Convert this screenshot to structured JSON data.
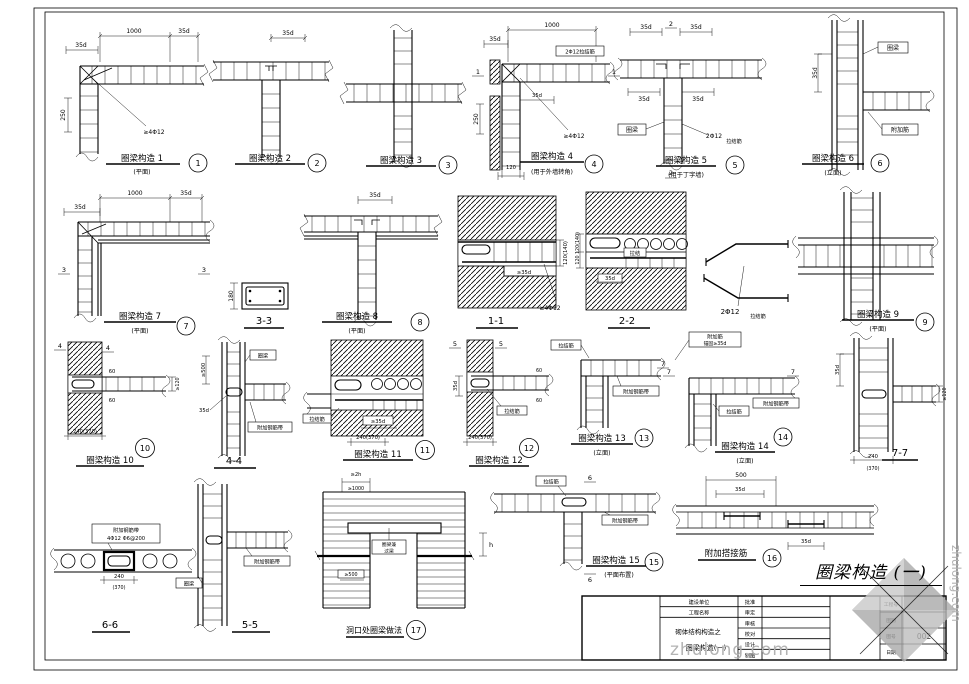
{
  "hand_title": "圈梁构造 (一)",
  "wm": {
    "text": "zhulong.com",
    "side": "zhulong.com"
  },
  "tb": {
    "client": "建设单位",
    "project": "工程名称",
    "series": "砌体结构构造之",
    "sheet": "圈梁构造(一)",
    "r1": "批准",
    "r2": "审定",
    "r3": "审核",
    "r4": "校对",
    "r5": "设计",
    "r6": "制图",
    "i1": "工程号",
    "i2": "图别",
    "i3": "图号",
    "i4": "日期",
    "no": "002"
  },
  "d": {
    "d1": {
      "t": "圈梁构造 1",
      "s": "(平面)",
      "n": "1",
      "dim1": "1000",
      "dim2": "35d",
      "dim3": "35d",
      "dim4": "250",
      "note": "≥4Φ12"
    },
    "d2": {
      "t": "圈梁构造 2",
      "n": "2",
      "dim1": "35d"
    },
    "d3": {
      "t": "圈梁构造 3",
      "n": "3"
    },
    "d4": {
      "t": "圈梁构造 4",
      "s": "(用于外墙转角)",
      "n": "4",
      "m": "1",
      "dim1": "1000",
      "dim2": "35d",
      "dim3": "250",
      "dim4": "35d",
      "dim5": "120",
      "note": "≥4Φ12",
      "box": "2Φ12拉结筋"
    },
    "d5": {
      "t": "圈梁构造 5",
      "s": "(用于丁字墙)",
      "n": "5",
      "m": "2",
      "dim1": "35d",
      "dim2": "35d",
      "dim3": "35d",
      "dim4": "35d",
      "note": "2Φ12",
      "note2": "拉结筋",
      "box": "圈梁"
    },
    "d6": {
      "t": "圈梁构造 6",
      "s": "(立面)",
      "n": "6",
      "dim1": "35d",
      "box1": "圈梁",
      "box2": "附加筋"
    },
    "d7": {
      "t": "圈梁构造 7",
      "s": "(平面)",
      "n": "7",
      "m": "3",
      "dim1": "1000",
      "dim2": "35d",
      "dim3": "35d"
    },
    "s33": {
      "t": "3-3",
      "dim1": "180"
    },
    "d8": {
      "t": "圈梁构造 8",
      "s": "(平面)",
      "n": "8",
      "dim1": "35d"
    },
    "s11": {
      "t": "1-1",
      "dim1": "120(140)",
      "dim2": "≥35d",
      "note": "≥4Φ12"
    },
    "s22": {
      "t": "2-2",
      "dim1": "120(140)",
      "dim2": "120",
      "dim3": "35d",
      "box": "拉结"
    },
    "bent": {
      "note": "2Φ12",
      "note2": "拉结筋"
    },
    "d9": {
      "t": "圈梁构造 9",
      "s": "(平面)",
      "n": "9"
    },
    "d10": {
      "t": "圈梁构造 10",
      "n": "10",
      "m": "4",
      "dim1": "60",
      "dim2": "60",
      "dim3": "≥120",
      "dim4": "240(370)"
    },
    "s44": {
      "t": "4-4",
      "dim1": "≥500",
      "dim2": "35d",
      "box1": "圈梁",
      "box2": "附加钢筋带"
    },
    "d11": {
      "t": "圈梁构造 11",
      "n": "11",
      "dim1": "240(370)",
      "dim2": "≥35d",
      "box": "拉结筋"
    },
    "d12": {
      "t": "圈梁构造 12",
      "n": "12",
      "m": "5",
      "dim1": "240(370)",
      "dim2": "35d",
      "dim3": "60",
      "dim4": "60",
      "box": "拉结筋"
    },
    "d13": {
      "t": "圈梁构造 13",
      "s": "(立面)",
      "n": "13",
      "m": "7",
      "box1": "拉结筋",
      "box2": "附加钢筋带"
    },
    "d14": {
      "t": "圈梁构造 14",
      "s": "(立面)",
      "n": "14",
      "m": "7",
      "note1": "附加筋",
      "note2": "锚固≥35d",
      "box1": "拉结筋",
      "box2": "附加钢筋带"
    },
    "s77": {
      "t": "7-7",
      "dim1": "35d",
      "dim2": "240",
      "dim3": "(370)",
      "dim4": "≥120"
    },
    "s66": {
      "t": "6-6",
      "note1": "附加钢筋带",
      "note2": "4Φ12 Φ6@200",
      "dim1": "240",
      "dim2": "(370)"
    },
    "s55": {
      "t": "5-5",
      "box1": "圈梁",
      "box2": "附加钢筋带"
    },
    "d17": {
      "t": "洞口处圈梁做法",
      "n": "17",
      "dim1": "≥2h",
      "dim2": "≥1000",
      "dim3": "h",
      "dim4": "≥500",
      "box1": "圈梁兼",
      "box2": "过梁"
    },
    "d15": {
      "t": "圈梁构造 15",
      "s": "(平面布置)",
      "n": "15",
      "m": "6",
      "box1": "拉结筋",
      "box2": "附加钢筋带"
    },
    "d16": {
      "t": "附加搭接筋",
      "n": "16",
      "dim1": "500",
      "dim2": "35d",
      "dim3": "35d"
    }
  }
}
